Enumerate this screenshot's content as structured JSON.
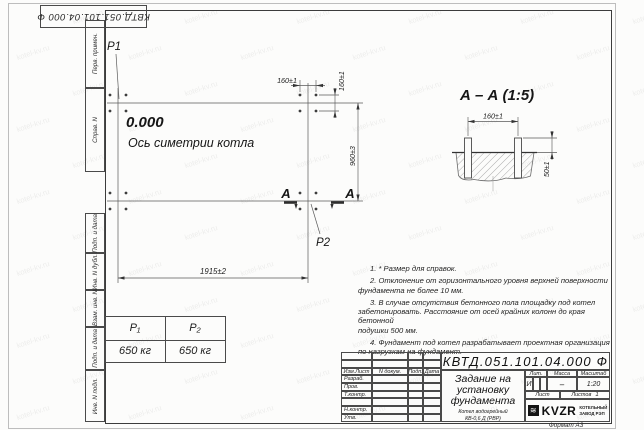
{
  "watermark": {
    "text": "kotel-kv.ru"
  },
  "corner_stamp": "КВТД.051.101.04.000 Ф",
  "side_columns": [
    {
      "label": "Перв. примен."
    },
    {
      "label": "Справ. N"
    },
    {
      "label": "Подп. и дата"
    },
    {
      "label": "Инв. N дубл."
    },
    {
      "label": "Взам. инв. N"
    },
    {
      "label": "Подп. и дата"
    },
    {
      "label": "Инв. N подл."
    }
  ],
  "plan": {
    "p1_label": "P1",
    "p2_label": "P2",
    "level_mark": "0.000",
    "axis_label": "Ось симетрии котла",
    "dim_160_top": "160±1",
    "dim_160_right": "160±1",
    "dim_960": "960±3",
    "dim_1915": "1915±2",
    "section_letter": "А"
  },
  "section_view": {
    "title": "А – А (1:5)",
    "dim_160": "160±1",
    "dim_50": "50±1"
  },
  "notes": [
    "1. * Размер для справок.",
    "2. Отклонение от горизонтального уровня верхней поверхности\nфундамента не более 10 мм.",
    "3. В случае отсутствия бетонного пола площадку под котел\nзабетонировать. Расстояние от осей крайних колонн до края бетонной\nподушки 500 мм.",
    "4. Фундамент под котел разрабатывает проектная организация\nпо нагрузкам на фундамент."
  ],
  "load_table": {
    "headers": [
      "P₁",
      "P₂"
    ],
    "values": [
      "650 кг",
      "650 кг"
    ]
  },
  "title_block": {
    "designation": "КВТД.051.101.04.000 Ф",
    "title": "Задание на установку фундамента",
    "subtitle_line1": "Котел водогрейный",
    "subtitle_line2": "КВ-0,6 Д (РВР)",
    "subtitle_line3": "по техническому заданию",
    "header_cols": [
      "Изм.Лист",
      "N докум.",
      "Подп.",
      "Дата"
    ],
    "rows": [
      "Разраб.",
      "Пров.",
      "Т.контр.",
      "",
      "Н.контр.",
      "Утв."
    ],
    "lit_header": "Лит.",
    "lit_value": "И",
    "mass_header": "Масса",
    "mass_value": "–",
    "scale_header": "Масштаб",
    "scale_value": "1:20",
    "sheet_label": "Лист",
    "sheets_label": "Листов",
    "sheets_value": "1",
    "logo_mark": "≋",
    "logo": "KVZR",
    "company_line1": "КОТЕЛЬНЫЙ",
    "company_line2": "ЗАВОД РЭП",
    "format_label": "Формат А3"
  }
}
